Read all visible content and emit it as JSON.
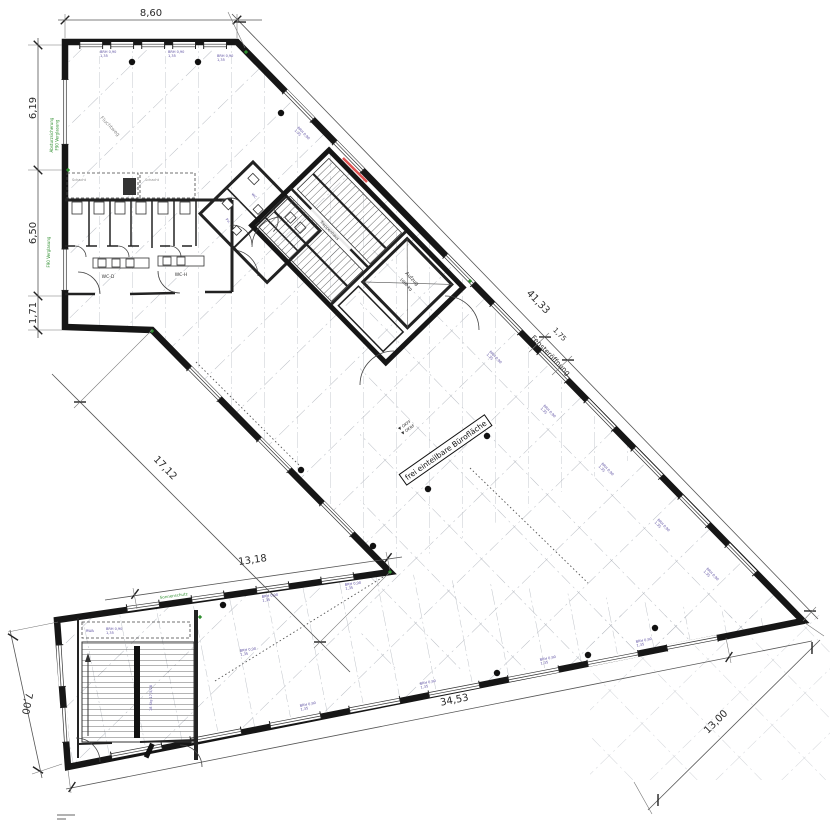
{
  "dimensions": {
    "top_width": "8,60",
    "left_upper": "6,19",
    "left_middle": "6,50",
    "left_lower": "1,71",
    "left_bottom_wing": "7,00",
    "facade_diagonal": "41,33",
    "window_opening": "1,75",
    "window_opening_label": "Fensteröffnung",
    "inner_diagonal": "17,12",
    "inner_edge": "13,18",
    "bottom_facade": "34,53",
    "right_end_width": "13,00"
  },
  "office": {
    "label": "frei einteilbare Bürofläche",
    "level1": "▼ OKFF",
    "level2": "▼ OKRF"
  },
  "core": {
    "stair": "Treppenhaus",
    "elevator": "Aufzug",
    "elevator_load": "1000 kg"
  },
  "rooms": {
    "wc_d": "WC-D",
    "wc_h": "WC-H",
    "anteroom_wc": "WC",
    "anteroom_pu": "Pu."
  },
  "annotations": {
    "shaft": "Schacht",
    "rwa": "RWA",
    "stair_note": "18 Stg 17,5/28",
    "green_left": "Absturzsicherung",
    "green_left2": "F90 Verglasung",
    "green_bottom": "Sonnenschutz",
    "gray_note": "Fluchtweg",
    "window_tag": "BRH 0,90",
    "window_tag2": "1,35"
  },
  "colors": {
    "wall": "#161616",
    "dimension_lines": "#555555",
    "grid": "#a8adb5",
    "annotation_green": "#2f8f2f",
    "annotation_purple": "#5b4ea0",
    "highlight_red": "#e05252"
  }
}
